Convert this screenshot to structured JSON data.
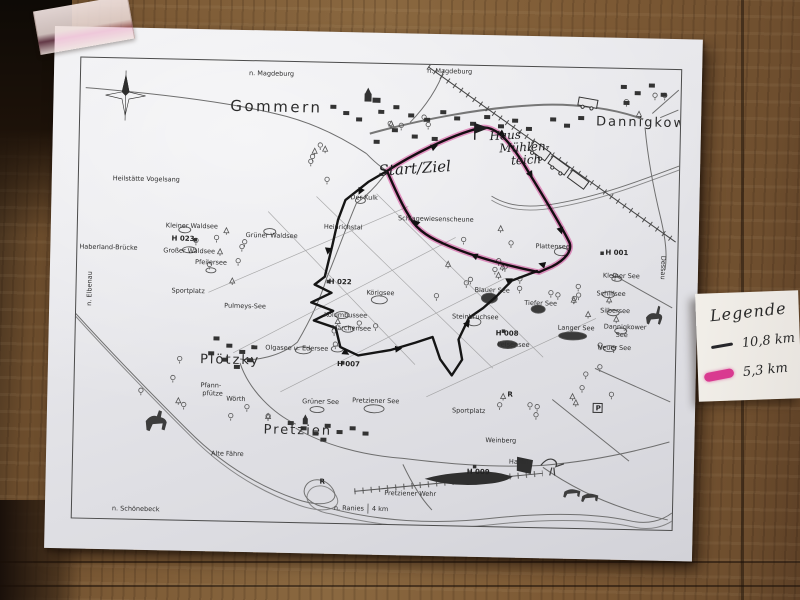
{
  "scene": {
    "setting": "Black-and-white cycling route map sheet taped to a wooden wall",
    "colors": {
      "wood": "#7a5a38",
      "paper": "#e9e8ea",
      "ink": "#1b1b1b",
      "marker_pink": "#d93a90"
    }
  },
  "map": {
    "towns": {
      "gommern": "Gommern",
      "dannigkow": "Dannigkow",
      "ploetzky": "Plötzky",
      "pretzien": "Pretzien"
    },
    "handwriting": {
      "start_ziel": "Start/Ziel",
      "haus": "Haus",
      "muehlen": "Mühlen-",
      "teich": "teich"
    },
    "labels": {
      "n_magdeburg": "n. Magdeburg",
      "heilstaette": "Heilstätte Vogelsang",
      "haberland": "Haberland-Brücke",
      "n_elbenau": "n. Elbenau",
      "kleiner_waldsee": "Kleiner Waldsee",
      "h023": "H 023",
      "grosser_waldsee": "Großer Waldsee",
      "gruener_waldsee": "Grüner Waldsee",
      "pfeilersee": "Pfeilersee",
      "sportplatz": "Sportplatz",
      "h022": "H 022",
      "koerigsee": "Körigsee",
      "kolumbussee": "Kolumbussee",
      "maerchensee": "Märchensee",
      "olgasee_edersee": "Olgasee u. Edersee",
      "h007": "H 007",
      "pulmeys_see": "Pulmeys-See",
      "der_kulk": "Der Kulk",
      "heinrichstal": "Heinrichstal",
      "scheune": "Schlagewiesenscheune",
      "plattensee": "Plattensee",
      "h001": "H 001",
      "kleiner_see": "Kleiner See",
      "schilfsee": "Schilfsee",
      "silbersee": "Silbersee",
      "dannigkower": "Dannigkower",
      "see": "See",
      "neuer_see": "Neuer See",
      "blauer_see": "Blauer See",
      "steinbruchsee": "Steinbruchsee",
      "tiefer_see": "Tiefer See",
      "langer_see": "Langer See",
      "h008": "H 008",
      "felsensee": "Felsensee",
      "pfann": "Pfann-",
      "pfuetze": "pfütze",
      "woerth": "Wörth",
      "gruener_see": "Grüner See",
      "pretziener_see": "Pretziener See",
      "weinberg": "Weinberg",
      "hafen": "Hafen",
      "h009": "H 009",
      "pretziener_wehr": "Pretziener Wehr",
      "n_ranies": "n. Ranies",
      "km4": "4 km",
      "alte_faehre": "Alte Fähre",
      "n_schoenebeck": "n. Schönebeck",
      "dessau": "Dessau",
      "r_mark": "R",
      "p_mark": "P"
    },
    "legend": {
      "title": "Legende",
      "items": [
        {
          "label": "10,8 km",
          "color": "#1b1b1b"
        },
        {
          "label": "5,3 km",
          "color": "#d93a90"
        }
      ]
    }
  }
}
